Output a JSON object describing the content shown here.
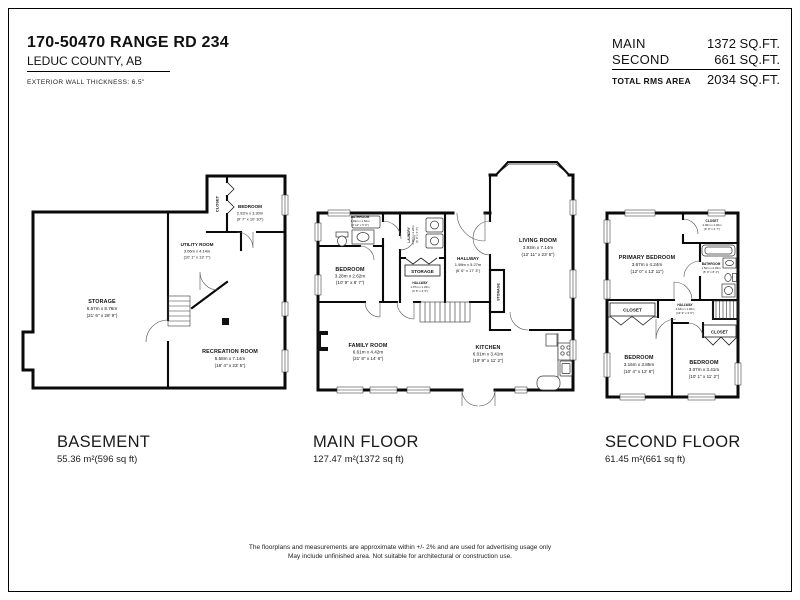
{
  "header": {
    "address": "170-50470 RANGE RD 234",
    "city": "LEDUC COUNTY, AB",
    "wall_note": "EXTERIOR WALL THICKNESS: 6.5\""
  },
  "area_table": {
    "main_label": "MAIN",
    "main_value": "1372 SQ.FT.",
    "second_label": "SECOND",
    "second_value": "661 SQ.FT.",
    "total_label": "TOTAL RMS AREA",
    "total_value": "2034 SQ.FT."
  },
  "floors": {
    "basement": {
      "title": "BASEMENT",
      "area": "55.36 m²(596 sq ft)",
      "rooms": {
        "closet": {
          "name": "CLOSET"
        },
        "bedroom": {
          "name": "BEDROOM",
          "metric": "2.92m x 3.30m",
          "imperial": "(9' 7\" x 10' 10\")"
        },
        "utility": {
          "name": "UTILITY ROOM",
          "metric": "3.06m x 4.14m",
          "imperial": "(10' 1\" x 13' 7\")"
        },
        "storage": {
          "name": "STORAGE",
          "metric": "6.57m x 8.76m",
          "imperial": "(21' 6\" x 28' 9\")"
        },
        "recreation": {
          "name": "RECREATION ROOM",
          "metric": "5.58m x 7.14m",
          "imperial": "(18' 4\" x 23' 5\")"
        }
      }
    },
    "main": {
      "title": "MAIN FLOOR",
      "area": "127.47 m²(1372 sq ft)",
      "rooms": {
        "bathroom": {
          "name": "BATHROOM",
          "metric": "1.49m x 1.52m",
          "imperial": "(4' 11\" x 5' 0\")"
        },
        "bedroom": {
          "name": "BEDROOM",
          "metric": "3.28m x 2.62m",
          "imperial": "(10' 9\" x 8' 7\")"
        },
        "laundry": {
          "name": "LAUNDRY",
          "metric": "2.05m x 2.28m",
          "imperial": "(6' 9\" x 7' 6\")"
        },
        "storage_box": {
          "name": "STORAGE"
        },
        "hallway_small": {
          "name": "HALLWAY",
          "metric": "1.07m x 1.34m",
          "imperial": "(3' 6\" x 4' 5\")"
        },
        "hallway": {
          "name": "HALLWAY",
          "metric": "1.98m x 5.27m",
          "imperial": "(6' 6\" x 17' 3\")"
        },
        "living": {
          "name": "LIVING ROOM",
          "metric": "3.93m x 7.14m",
          "imperial": "(12' 11\" x 23' 5\")"
        },
        "storage_closet": {
          "name": "STORAGE"
        },
        "family": {
          "name": "FAMILY ROOM",
          "metric": "6.61m x 4.42m",
          "imperial": "(21' 8\" x 14' 6\")"
        },
        "kitchen": {
          "name": "KITCHEN",
          "metric": "6.01m x 3.41m",
          "imperial": "(19' 9\" x 11' 2\")"
        }
      }
    },
    "second": {
      "title": "SECOND FLOOR",
      "area": "61.45 m²(661 sq ft)",
      "rooms": {
        "primary": {
          "name": "PRIMARY BEDROOM",
          "metric": "3.67m x 4.24m",
          "imperial": "(12' 0\" x 13' 11\")"
        },
        "closet_top": {
          "name": "CLOSET",
          "metric": "2.06m x 1.40m",
          "imperial": "(6' 9\" x 4' 7\")"
        },
        "bathroom": {
          "name": "BATHROOM",
          "metric": "1.52m x 2.49m",
          "imperial": "(5' 0\" x 8' 2\")"
        },
        "hallway": {
          "name": "HALLWAY",
          "metric": "4.18m x 1.06m",
          "imperial": "(13' 9\" x 3' 6\")"
        },
        "closet_left": {
          "name": "CLOSET"
        },
        "closet_right": {
          "name": "CLOSET"
        },
        "bedroom_left": {
          "name": "BEDROOM",
          "metric": "3.16m x 3.85m",
          "imperial": "(10' 4\" x 12' 8\")"
        },
        "bedroom_right": {
          "name": "BEDROOM",
          "metric": "3.07m x 3.41m",
          "imperial": "(10' 1\" x 11' 2\")"
        }
      }
    }
  },
  "disclaimer": {
    "line1": "The floorplans and measurements are approximate within +/- 2% and are used for advertising usage only",
    "line2": "May include unfinished area. Not suitable for architectural or construction use."
  }
}
